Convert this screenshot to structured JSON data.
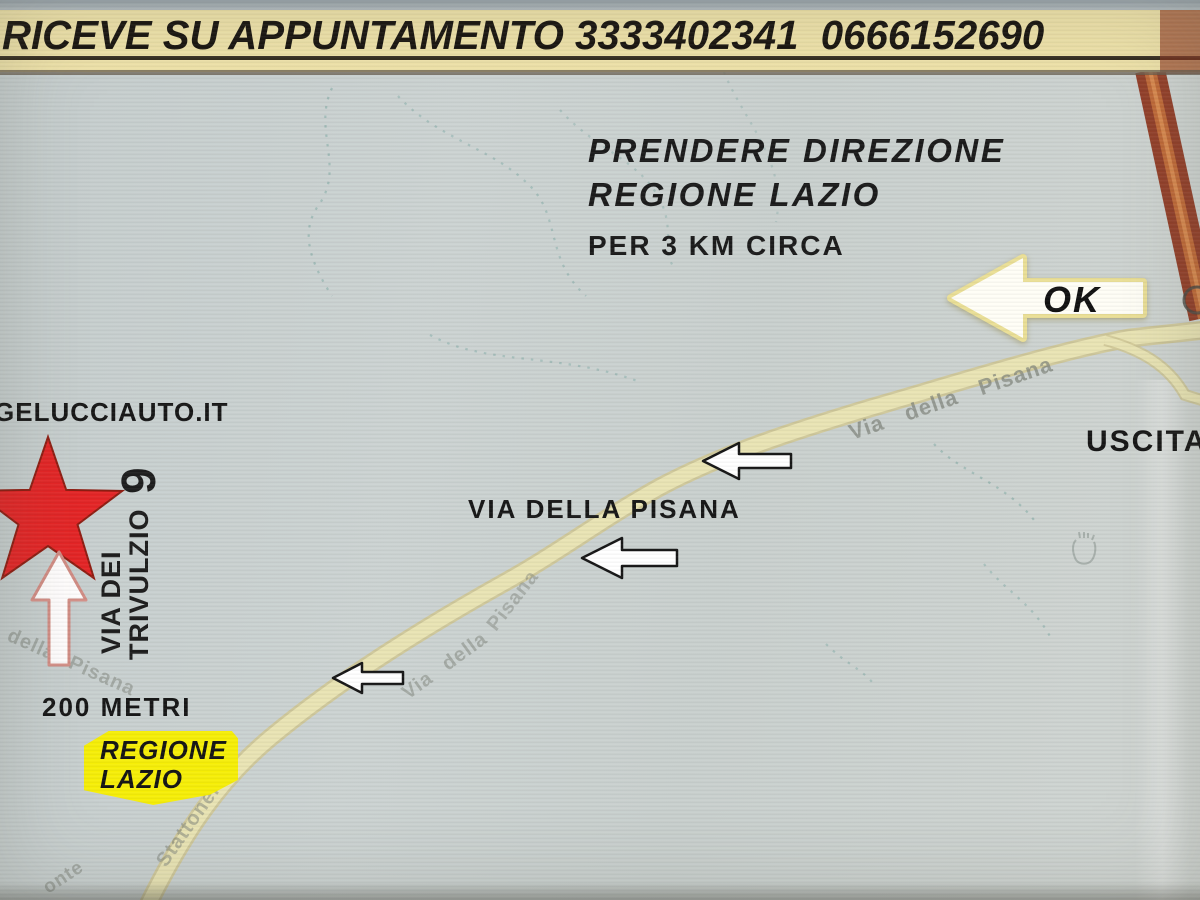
{
  "header": {
    "title": "RICEVE SU APPUNTAMENTO 3333402341  0666152690"
  },
  "directions": {
    "line1": "PRENDERE DIREZIONE",
    "line2": "REGIONE LAZIO",
    "line3": "PER 3 KM CIRCA"
  },
  "ok_arrow": {
    "label": "OK"
  },
  "exit": {
    "label": "USCITA"
  },
  "street": {
    "main_label": "VIA DELLA PISANA",
    "distance": "200 METRI"
  },
  "destination": {
    "website": "GELUCCIAUTO.IT",
    "street_line1": "VIA DEI",
    "street_line2": "TRIVULZIO",
    "number": "9"
  },
  "badge": {
    "line1": "REGIONE",
    "line2": "LAZIO"
  },
  "map_labels": {
    "road_main": "Via della Pisana",
    "road_left": "della Pisana",
    "road_mid1": "Via della",
    "road_mid2": "Pisana",
    "stattonera": "Stattonera",
    "monte": "onte"
  },
  "colors": {
    "header_bg": "#eee2a9",
    "map_bg": "#cbd2d1",
    "road_fill": "#e9e4b4",
    "road_casing": "#cfc795",
    "highway": "#93402a",
    "highway_center": "#c06a38",
    "star": "#e42526",
    "badge_bg": "#f6ee07",
    "arrow_fill": "#ffffff",
    "arrow_outline": "#161616",
    "ok_arrow_glow": "#eadf96"
  }
}
